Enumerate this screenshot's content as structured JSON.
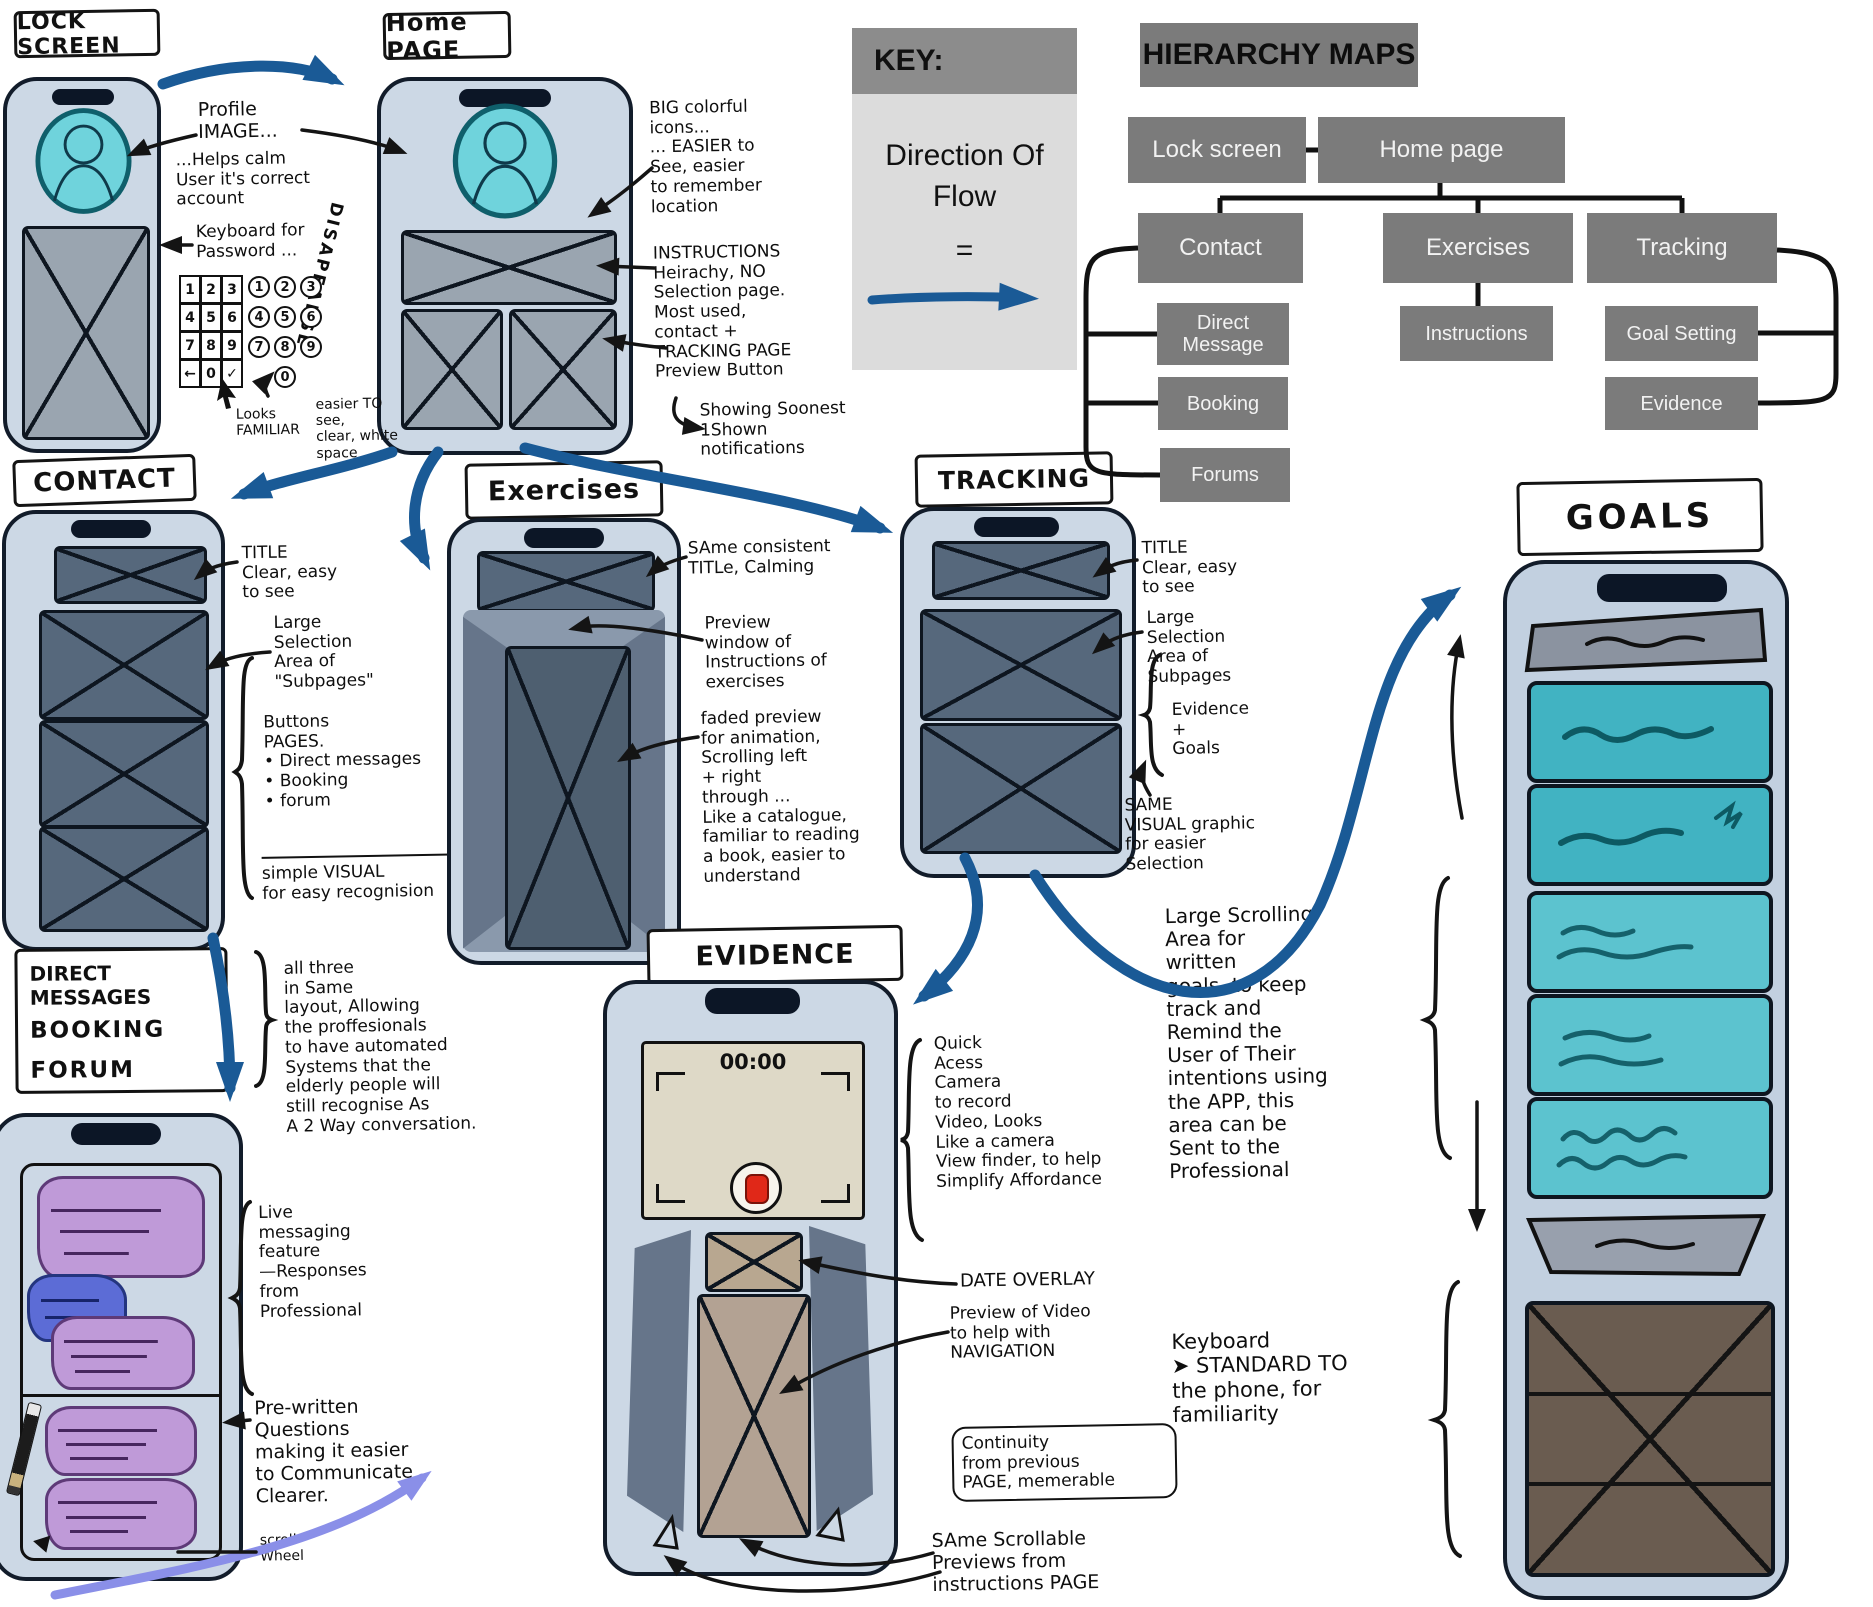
{
  "page_labels": {
    "lock_screen": "LOCK SCREEN",
    "home_page": "Home PAGE",
    "contact": "CONTACT",
    "exercises": "Exercises",
    "tracking": "TRACKING",
    "evidence": "EVIDENCE",
    "goals": "GOALS"
  },
  "messages_label": {
    "line1": "DIRECT MESSAGES",
    "line2": "BOOKING",
    "line3": "FORUM"
  },
  "key_box": {
    "title": "KEY:",
    "body": "Direction Of Flow",
    "equals": "="
  },
  "hierarchy": {
    "title": "HIERARCHY MAPS",
    "nodes": {
      "lock_screen": "Lock screen",
      "home_page": "Home page",
      "contact": "Contact",
      "exercises": "Exercises",
      "tracking": "Tracking",
      "direct_message": "Direct Message",
      "booking": "Booking",
      "forums": "Forums",
      "instructions": "Instructions",
      "goal_setting": "Goal Setting",
      "evidence": "Evidence"
    }
  },
  "lock": {
    "keypad": {
      "keys": [
        "1",
        "2",
        "3",
        "4",
        "5",
        "6",
        "7",
        "8",
        "9",
        "←",
        "0",
        "✓"
      ],
      "circle_keys": [
        "1",
        "2",
        "3",
        "4",
        "5",
        "6",
        "7",
        "8",
        "9",
        "0"
      ]
    }
  },
  "evidence_screen": {
    "timer": "00:00"
  },
  "annotations": {
    "profile_image": "Profile\nIMAGE...",
    "helps_calm": "...Helps calm\nUser it's correct\naccount",
    "keyboard_password": "Keyboard for\nPassword ...",
    "disappears": "DISAPEARSE",
    "looks_familiar": "Looks\nFAMILIAR",
    "easier_to_see": "easier TO\nsee,\nclear, white\nspace",
    "big_icons": "BIG colorful\nicons...\n... EASIER to\nSee, easier\nto remember\nlocation",
    "instructions_hierarchy": "INSTRUCTIONS\nHeirachy, NO\nSelection page.\nMost used,\ncontact +\nTRACKING PAGE\nPreview Button",
    "showing_notifications": "Showing Soonest\n1Shown\nnotifications",
    "contact_title_note": "TITLE\nClear, easy\nto see",
    "contact_selection_note": "Large\nSelection\nArea of\n\"Subpages\"",
    "contact_buttons_note": "Buttons\nPAGES.\n• Direct messages\n• Booking\n• forum",
    "contact_visual_note": "simple VISUAL\nfor easy recognision",
    "exercises_title_note": "SAme consistent\nTITLe, Calming",
    "exercises_preview_note": "Preview\nwindow of\nInstructions of\nexercises",
    "exercises_faded_note": "faded preview\nfor animation,\nScrolling left\n+ right\nthrough ...\nLike a catalogue,\nfamiliar to reading\na book, easier to\nunderstand",
    "tracking_title_note": "TITLE\nClear, easy\nto see",
    "tracking_selection_note": "Large\nSelection\nArea of\nSubpages",
    "tracking_evidence_goals": "Evidence\n+\nGoals",
    "tracking_visual_note": "SAME\nVISUAL graphic\nfor easier\nSelection",
    "dm_all_three": "all three\nin Same\nlayout, Allowing\nthe proffesionals\nto have automated\nSystems that the\nelderly people will\nstill recognise As\nA 2 Way conversation.",
    "dm_live": "Live\nmessaging\nfeature\n—Responses\nfrom\nProfessional",
    "dm_prewritten": "Pre-written\nQuestions\nmaking it easier\nto Communicate\nClearer.",
    "dm_scroll_wheel": "scroll\nWheel",
    "ev_quick_access": "Quick\nAcess\nCamera\nto record\nVideo, Looks\nLike a camera\nView finder, to help\nSimplify Affordance",
    "ev_date_overlay": "DATE OVERLAY",
    "ev_preview_note": "Preview of Video\nto help with\nNAVIGATION",
    "ev_continuity": "Continuity\nfrom previous\nPAGE, memerable",
    "ev_same_scrollable": "SAme Scrollable\nPreviews from\ninstructions PAGE",
    "goals_scrolling": "Large Scrolling\nArea for\nwritten\ngoals, to keep\ntrack and\nRemind the\nUser of Their\nintentions using\nthe APP, this\narea can be\nSent to the\nProfessional",
    "goals_keyboard": "Keyboard\n➤ STANDARD TO\nthe phone, for\nfamiliarity"
  },
  "colors": {
    "flow_arrow_blue": "#1a5a96",
    "scroll_arrow_purple": "#8a8fe8",
    "phone_body": "#ccd8e5",
    "panel_slate": "#56687c",
    "avatar_teal": "#6fd3dc",
    "goal_teal_dark": "#41b3c2",
    "goal_teal_light": "#5cc3cf",
    "hierarchy_gray": "#7b7b7b",
    "record_red": "#e02818",
    "bubble_purple": "#bf9ad8",
    "bubble_blue": "#5c6cd6",
    "keyboard_brown": "#6a5c50"
  }
}
